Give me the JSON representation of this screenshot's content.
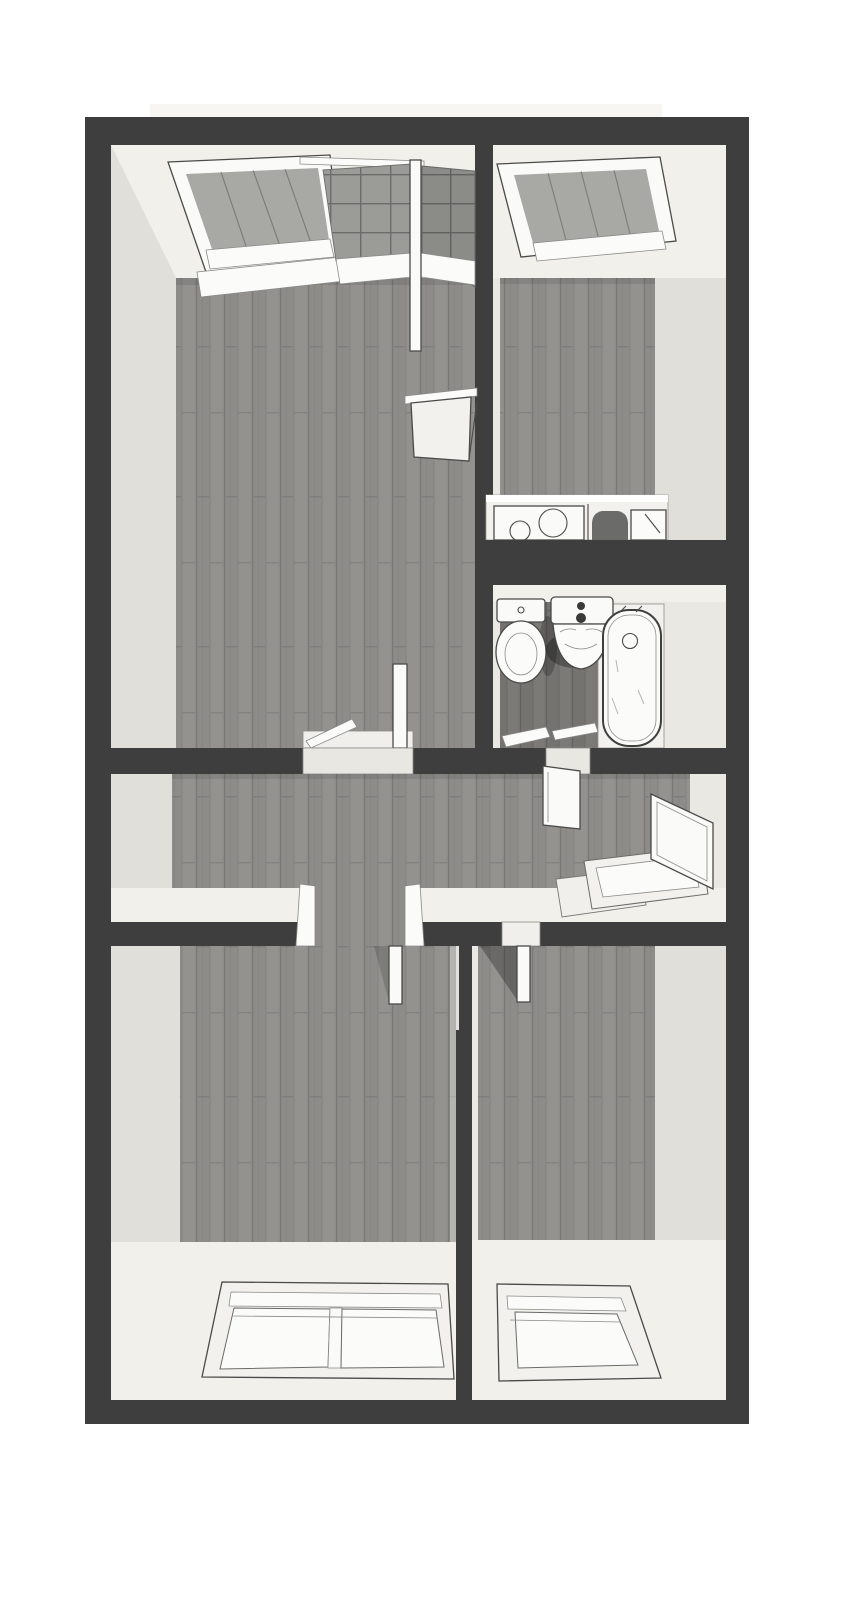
{
  "meta": {
    "view": "3d-top-down-dollhouse-floor-plan",
    "style": "grayscale-architectural-render",
    "visible_text": ""
  },
  "colors": {
    "page_bg": "#ffffff",
    "roof_strip": "#f7f6f3",
    "structure_wall": "#3e3e3e",
    "wall_light": "#eae8e3",
    "wall_bright": "#f1f0eb",
    "wall_shade": "#e1dfd9",
    "floor_wood": "#8d8c89",
    "floor_wood_dark": "#747370",
    "tile": "#9b9b98",
    "glass_gray": "#a8a8a5",
    "glass_white": "#fbfbfa",
    "fixture_white": "#fafaf8",
    "counter_white": "#f2f1ed",
    "threshold": "#f0efeb",
    "gap_fill": "#e9e7e2",
    "sink_dark": "#6b6b69",
    "lit_edge": "#e3e1db"
  },
  "building": {
    "rooms": [
      {
        "id": "living-room",
        "floor": "wood",
        "fixtures": [
          "roof-window",
          "tiled-balcony-doorway",
          "kitchen-door",
          "hall-doorway",
          "open-door-panel"
        ]
      },
      {
        "id": "kitchen",
        "floor": "wood",
        "fixtures": [
          "roof-window",
          "counter",
          "cooktop-two-burners",
          "sink",
          "drainboard"
        ]
      },
      {
        "id": "bathroom",
        "floor": "wood",
        "fixtures": [
          "toilet",
          "washbasin",
          "bathtub",
          "open-door-slabs"
        ]
      },
      {
        "id": "hallway",
        "floor": "wood",
        "fixtures": [
          "bathroom-door-panel",
          "entrance-door-open",
          "entrance-step",
          "bedroom-doorways"
        ]
      },
      {
        "id": "bedroom-left",
        "floor": "wood",
        "fixtures": [
          "double-sliding-window",
          "open-door-panel"
        ]
      },
      {
        "id": "bedroom-right",
        "floor": "wood",
        "fixtures": [
          "single-window",
          "open-door-panel",
          "door-shadow"
        ]
      }
    ]
  }
}
